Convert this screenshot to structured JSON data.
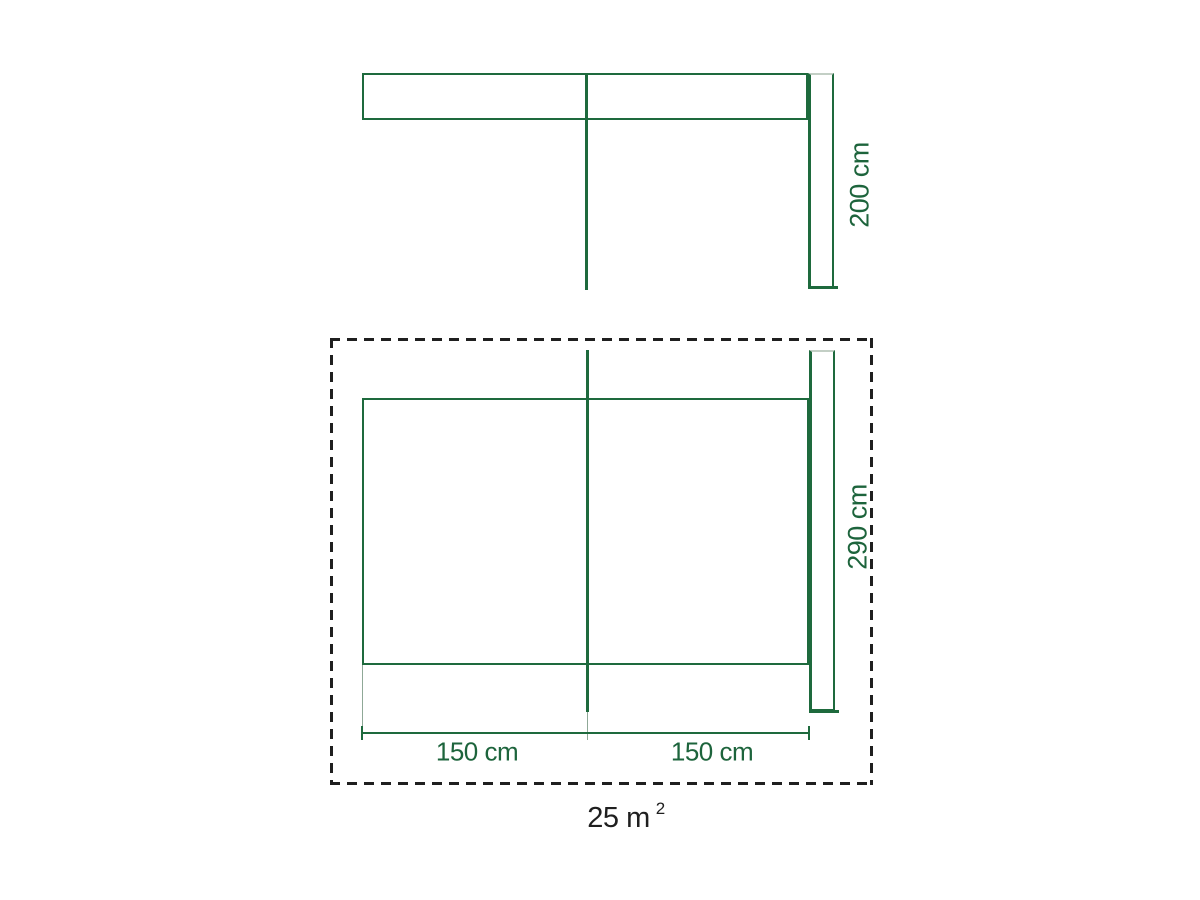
{
  "figures": {
    "top_view": {
      "height_dimension": "200 cm"
    },
    "floor_plan": {
      "height_dimension": "290 cm",
      "width_dimension_left": "150 cm",
      "width_dimension_right": "150 cm"
    },
    "area": {
      "value": "25 m",
      "superscript": "2"
    }
  },
  "colors": {
    "line_green": "#1e6a3d",
    "text_green": "#1d643c",
    "ext_green": "#8fa897",
    "light_edge": "#c3cfc5",
    "dash": "#1f1f1f",
    "area_text": "#1f1f1f"
  }
}
